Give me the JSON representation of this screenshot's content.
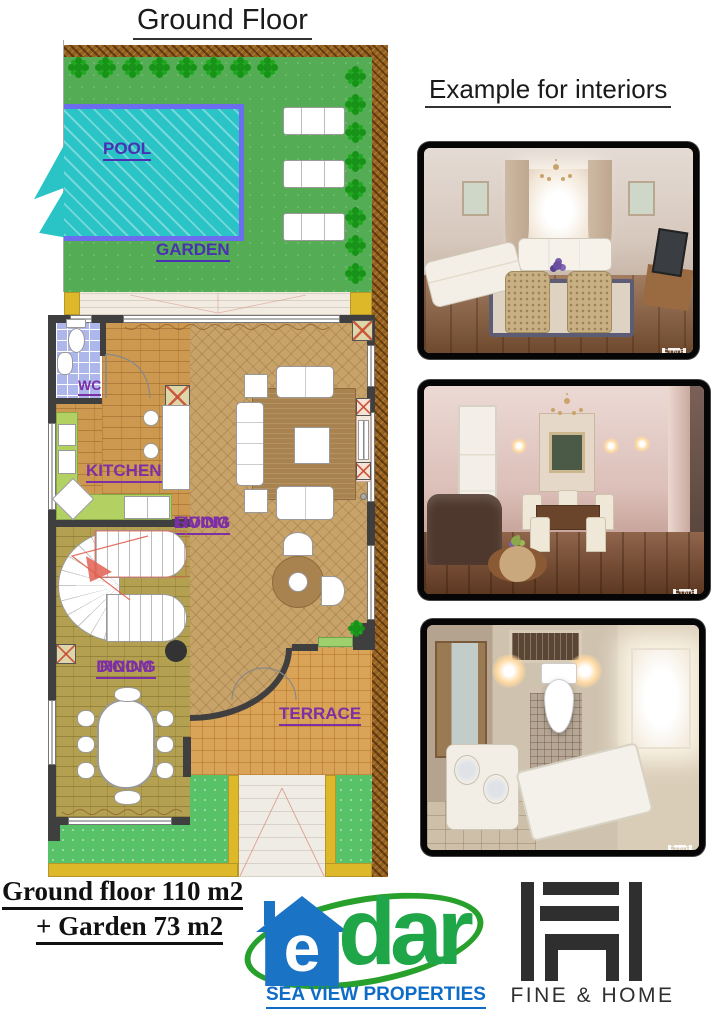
{
  "page_title": "Ground Floor",
  "plan": {
    "pool_label": "POOL",
    "garden_label": "GARDEN",
    "wc_label": "WC",
    "kitchen_label": "KITCHEN",
    "living_line1": "LIVING",
    "living_line2": "ROOM",
    "dining_line1": "DINING",
    "dining_line2": "ROOM",
    "terrace_label": "TERRACE",
    "colors": {
      "garden_green": "#54ac54",
      "pool_water": "#2bc4c6",
      "pool_border": "#6c6cf0",
      "room_label_purple": "#7d2fa5",
      "pool_label_purple": "#4b2fb4",
      "wall_gray": "#3f3f3f",
      "hatch_border_brown": "#96601f",
      "yellow_trim": "#ddb92a"
    }
  },
  "interiors": {
    "title": "Example for interiors",
    "photos": [
      {
        "name": "classic living room render",
        "watermark": "FINE & HOME"
      },
      {
        "name": "classic dining room render",
        "watermark": "FINE & HOME"
      },
      {
        "name": "bathroom top view render",
        "watermark": "FINE & HOME"
      }
    ]
  },
  "footer": {
    "area_line1": "Ground floor 110 m2",
    "area_line2": "+ Garden 73 m2",
    "edar": {
      "letter_e": "e",
      "letters_dar": "dar",
      "tagline": "SEA VIEW PROPERTIES",
      "house_blue": "#1a73c4",
      "text_green": "#1fa648",
      "tagline_blue": "#0e6cc8"
    },
    "fine_home": {
      "label": "FINE & HOME",
      "color": "#2f2f2f"
    }
  }
}
